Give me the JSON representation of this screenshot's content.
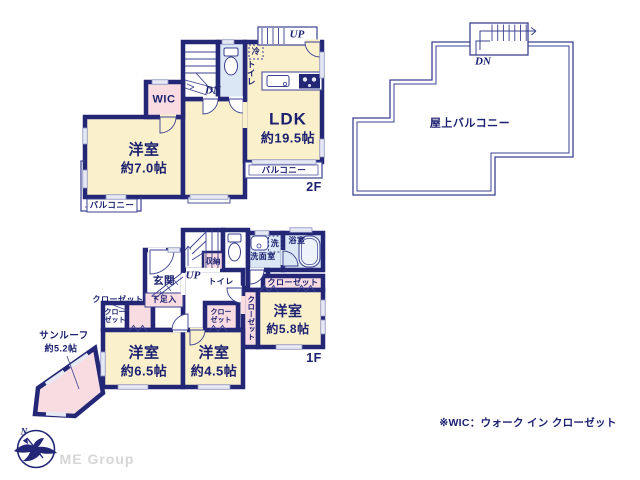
{
  "colors": {
    "wall": "#232776",
    "thin_line": "#3b4190",
    "room_cream": "#faf0cb",
    "closet_pink": "#f8dce2",
    "wet_blue": "#dbe7f4",
    "window_gray": "#e6e9f4",
    "logo_gray": "#d6d6d6"
  },
  "floor2": {
    "floor_label": "2F",
    "rooms": {
      "yoshitsu7": {
        "name": "洋室",
        "area": "約7.0帖"
      },
      "ldk": {
        "name": "LDK",
        "area": "約19.5帖"
      },
      "wic": {
        "name": "WIC"
      }
    },
    "labels": {
      "up": "UP",
      "dn": "DN",
      "toilet": "トイレ",
      "fridge": "冷",
      "balcony_left": "バルコニー",
      "balcony_right": "バルコニー"
    }
  },
  "roof": {
    "dn": "DN",
    "name": "屋上バルコニー"
  },
  "floor1": {
    "floor_label": "1F",
    "rooms": {
      "yoshitsu65": {
        "name": "洋室",
        "area": "約6.5帖"
      },
      "yoshitsu45": {
        "name": "洋室",
        "area": "約4.5帖"
      },
      "yoshitsu58": {
        "name": "洋室",
        "area": "約5.8帖"
      },
      "sunroof": {
        "name": "サンルーフ",
        "area": "約5.2帖"
      }
    },
    "labels": {
      "genkan": "玄関",
      "shoe_box": "下足入",
      "up": "UP",
      "storage": "収納",
      "toilet": "トイレ",
      "washroom": "洗面室",
      "washer": "洗",
      "bathroom": "浴室",
      "closet": "クローゼット"
    }
  },
  "note": "※WIC：ウォーク イン クローゼット",
  "logo": {
    "company": "ME Group",
    "north": "N"
  }
}
